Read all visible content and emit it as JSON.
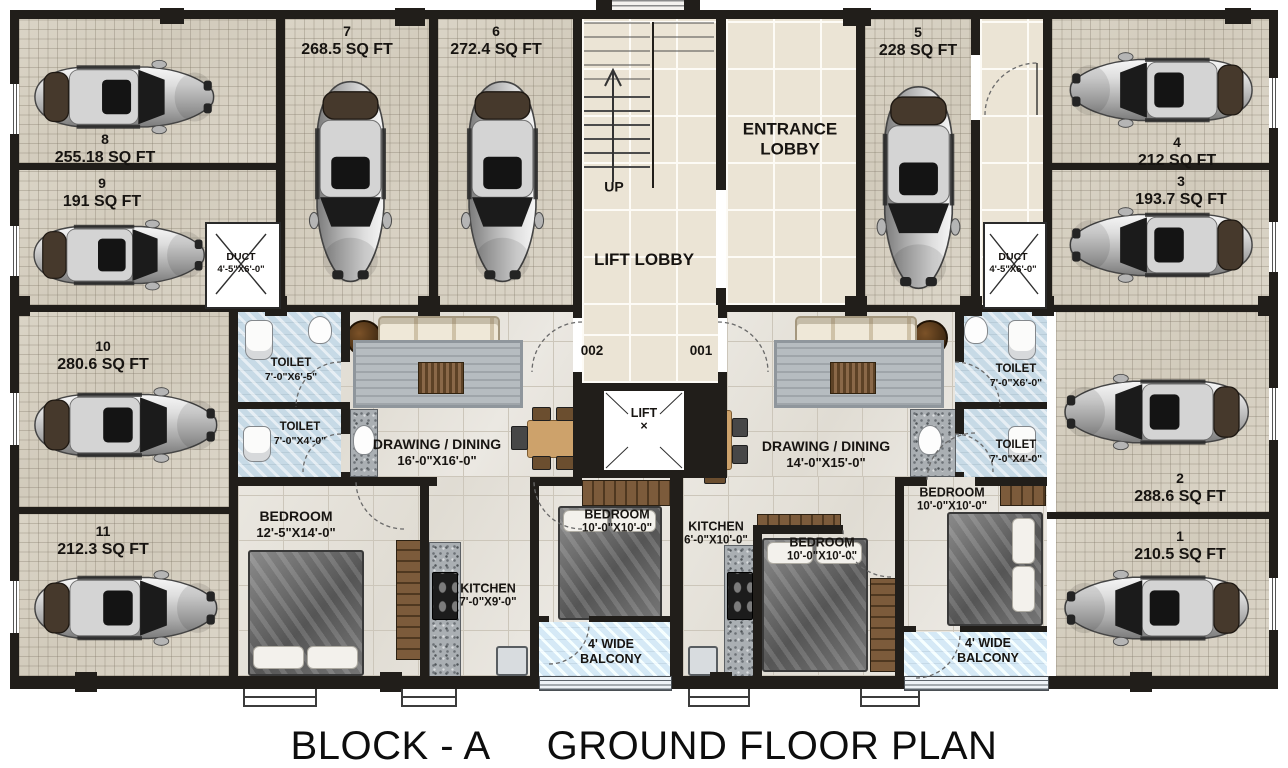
{
  "title": {
    "block": "BLOCK - A",
    "plan": "GROUND FLOOR PLAN"
  },
  "common": {
    "entrance_lobby": "ENTRANCE LOBBY",
    "lift_lobby": "LIFT LOBBY",
    "lift": "LIFT",
    "lift_mark": "×",
    "up": "UP",
    "flat_left": "002",
    "flat_right": "001",
    "duct_left": {
      "name": "DUCT",
      "dim": "4'-5\"X6'-0\""
    },
    "duct_right": {
      "name": "DUCT",
      "dim": "4'-5\"X6'-0\""
    }
  },
  "parking": {
    "p1": {
      "num": "1",
      "area": "210.5 SQ FT"
    },
    "p2": {
      "num": "2",
      "area": "288.6 SQ FT"
    },
    "p3": {
      "num": "3",
      "area": "193.7 SQ FT"
    },
    "p4": {
      "num": "4",
      "area": "212 SQ FT"
    },
    "p5": {
      "num": "5",
      "area": "228 SQ FT"
    },
    "p6": {
      "num": "6",
      "area": "272.4 SQ FT"
    },
    "p7": {
      "num": "7",
      "area": "268.5 SQ FT"
    },
    "p8": {
      "num": "8",
      "area": "255.18 SQ FT"
    },
    "p9": {
      "num": "9",
      "area": "191 SQ FT"
    },
    "p10": {
      "num": "10",
      "area": "280.6 SQ FT"
    },
    "p11": {
      "num": "11",
      "area": "212.3 SQ FT"
    }
  },
  "unit_left": {
    "toilet_big": {
      "name": "TOILET",
      "dim": "7'-0\"X6'-5\""
    },
    "toilet_small": {
      "name": "TOILET",
      "dim": "7'-0\"X4'-0\""
    },
    "drawing": {
      "name": "DRAWING / DINING",
      "dim": "16'-0\"X16'-0\""
    },
    "bedroom_master": {
      "name": "BEDROOM",
      "dim": "12'-5\"X14'-0\""
    },
    "bedroom2": {
      "name": "BEDROOM",
      "dim": "10'-0\"X10'-0\""
    },
    "kitchen": {
      "name": "KITCHEN",
      "dim": "7'-0\"X9'-0\""
    },
    "balcony": {
      "line1": "4' WIDE",
      "line2": "BALCONY"
    }
  },
  "unit_right": {
    "toilet_big": {
      "name": "TOILET",
      "dim": "7'-0\"X6'-0\""
    },
    "toilet_small": {
      "name": "TOILET",
      "dim": "7'-0\"X4'-0\""
    },
    "drawing": {
      "name": "DRAWING / DINING",
      "dim": "14'-0\"X15'-0\""
    },
    "bedroom2": {
      "name": "BEDROOM",
      "dim": "10'-0\"X10'-0\""
    },
    "bedroom3": {
      "name": "BEDROOM",
      "dim": "10'-0\"X10'-0\""
    },
    "kitchen": {
      "name": "KITCHEN",
      "dim": "6'-0\"X10'-0\""
    },
    "balcony": {
      "line1": "4' WIDE",
      "line2": "BALCONY"
    }
  },
  "colors": {
    "wall": "#211e1a",
    "parking_floor": "#d7d1c3",
    "lobby_floor": "#ebe4d5",
    "apartment_floor": "#e7e3db",
    "wet_area_floor": "#c7dae6",
    "title_text": "#0d0d0d"
  }
}
